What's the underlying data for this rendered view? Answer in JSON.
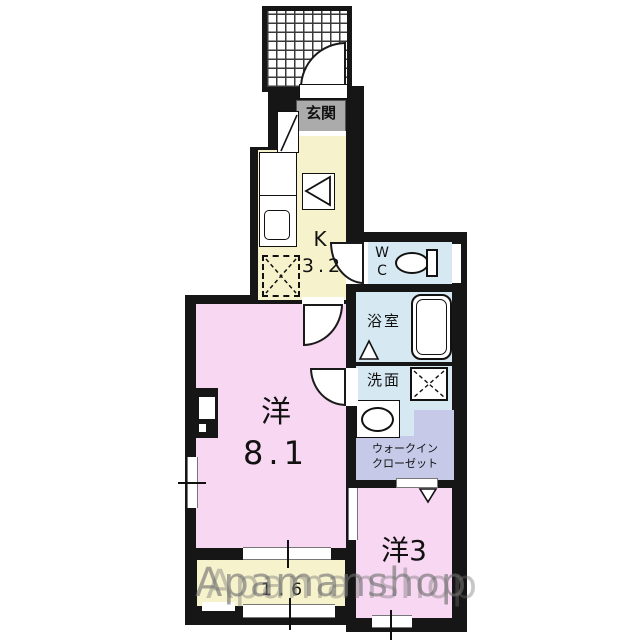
{
  "watermark": {
    "text": "Apamanshop"
  },
  "rooms": {
    "genkan": {
      "label": "玄関"
    },
    "kitchen": {
      "type": "K",
      "size": "3.2"
    },
    "wc": {
      "line1": "W",
      "line2": "C"
    },
    "bath": {
      "label": "浴室"
    },
    "washroom": {
      "label": "洗面"
    },
    "closet": {
      "line1": "ウォークイン",
      "line2": "クローゼット"
    },
    "main_room": {
      "type": "洋",
      "size": "8.1"
    },
    "small_room": {
      "label": "洋3"
    },
    "balcony": {
      "size": "1.6"
    }
  },
  "fixtures": {
    "entrance_porch": "tiled-grid",
    "entrance_door": "swing-arc",
    "shoe_cabinet": "box-with-diagonal",
    "kitchen_counter": "counter-with-sink",
    "stove": "triangle-in-box",
    "refrigerator_space": "dashed-x-box",
    "toilet": "oval-with-tank",
    "bathtub": "rounded-rect",
    "washing_machine_space": "x-box",
    "wash_basin": "oval-basin",
    "closet_door": "v-arrow",
    "sliding_door": "white-slot"
  },
  "colors": {
    "wall": "#161616",
    "kitchen_floor": "#f6f2cc",
    "room_floor": "#f8d7f2",
    "wet_area_floor": "#d6e9f2",
    "closet_floor": "#c6c9e8",
    "genkan_tile": "#ababab",
    "watermark": "#6f6f6f"
  }
}
